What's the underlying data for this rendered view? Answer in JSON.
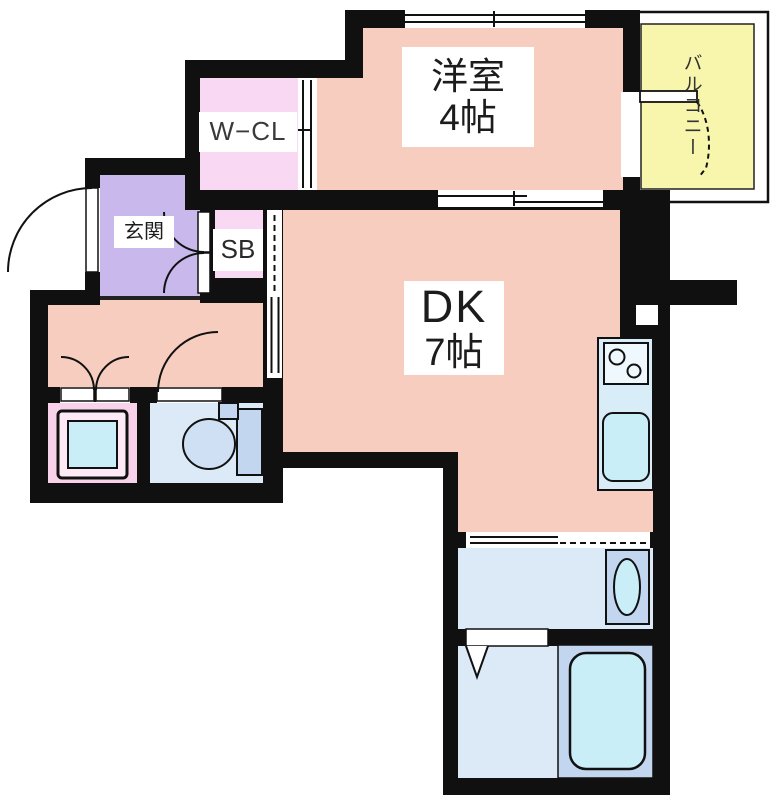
{
  "plan": {
    "title": "1DK apartment floor plan",
    "rooms": [
      {
        "name": "洋室",
        "size": "4帖"
      },
      {
        "name": "DK",
        "size": "7帖"
      },
      {
        "name": "W−CL"
      },
      {
        "name": "玄関"
      },
      {
        "name": "SB"
      },
      {
        "name": "バルコニー"
      }
    ],
    "fixtures": [
      "kitchen-counter",
      "stove-burners",
      "kitchen-sink",
      "bathtub",
      "vanity-basin",
      "toilet",
      "washing-machine-pan",
      "shower-symbol",
      "entrance-door",
      "balcony-door",
      "sliding-doors",
      "double-doors",
      "windows"
    ],
    "colors": {
      "salmon": "#f6cdbe",
      "pink": "#f9d8f4",
      "purple": "#c9b8ec",
      "washpink": "#f8d2ea",
      "blue": "#dce9f7",
      "cyan": "#c9eef8",
      "midblue": "#c2d6ef",
      "counter": "#d9edf8",
      "yellow": "#f8f5ad",
      "wall": "#101010"
    }
  }
}
